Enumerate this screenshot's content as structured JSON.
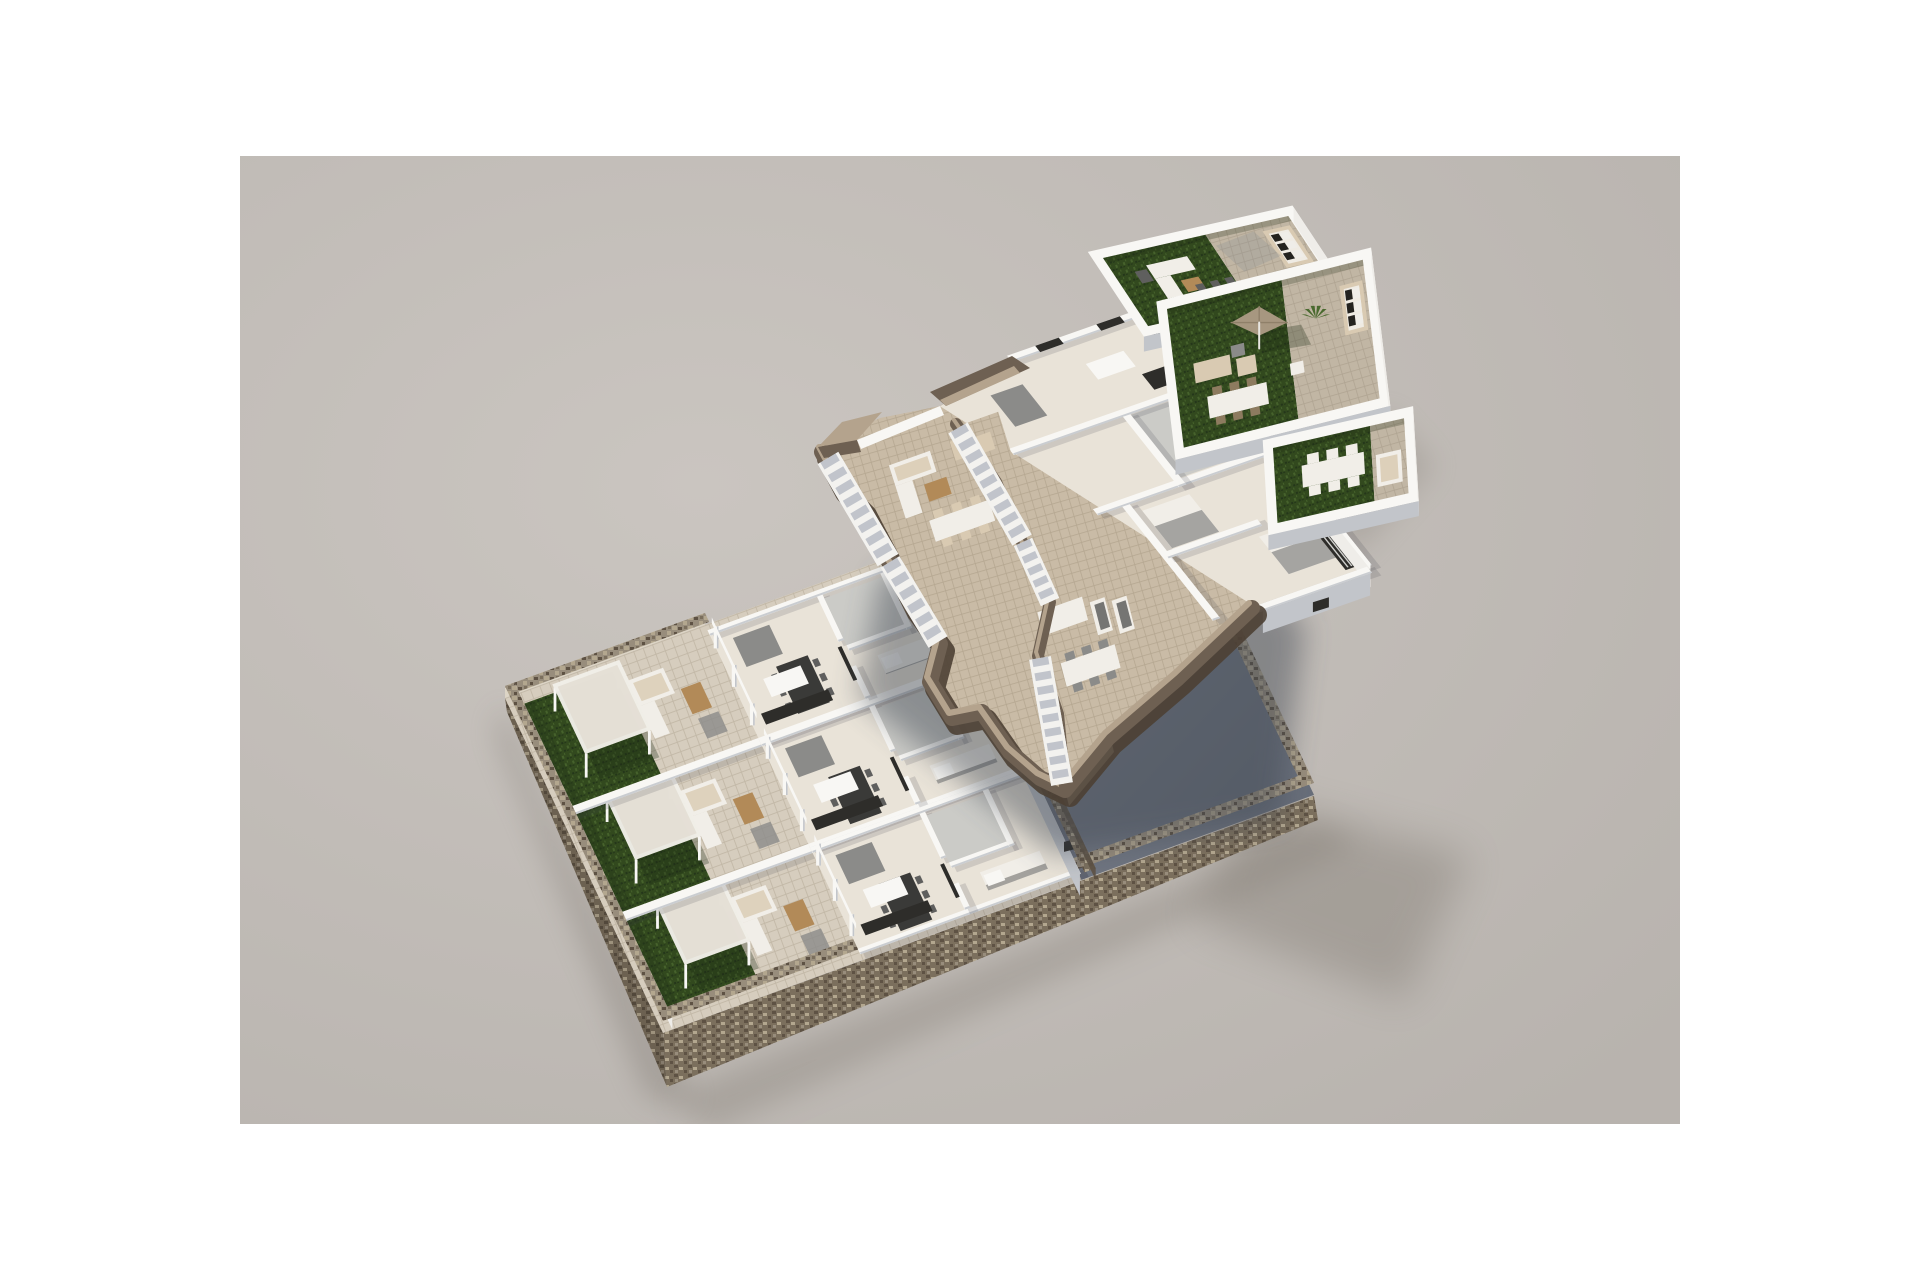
{
  "scene": {
    "type": "architectural-3d-exploded-floorplan-render",
    "render_area": {
      "x": 240,
      "y": 156,
      "width": 1440,
      "height": 968
    },
    "floors": [
      {
        "id": "ground-floor",
        "position": "bottom-left",
        "features": [
          "stone-perimeter-wall",
          "three-gardens",
          "pergolas",
          "terraces",
          "apartments",
          "sunken-patio-slab"
        ]
      },
      {
        "id": "first-floor",
        "position": "center",
        "floating": true,
        "features": [
          "rock-cut-fascia",
          "terrace-decks",
          "staircases",
          "apartments",
          "outdoor-lounge"
        ]
      },
      {
        "id": "roof-terrace",
        "position": "top-right",
        "floating": true,
        "features": [
          "three-stepped-terraces",
          "artificial-turf",
          "parasol",
          "outdoor-sofas",
          "dining-sets"
        ]
      }
    ],
    "counts": {
      "gardens": 3,
      "pergolas": 3,
      "roof_terrace_sections": 3,
      "staircases": 4
    },
    "palette": {
      "page_bg": "#ffffff",
      "canvas_center": "#cac5c0",
      "canvas_edge": "#b8b3ae",
      "stone_top": "#988d7c",
      "stone_dark": "#7b6f5d",
      "stone_speck1": "#5e5244",
      "stone_speck2": "#b3a78f",
      "stone_face_light": "#ddd5c6",
      "turf": "#32491e",
      "turf_light": "#46622c",
      "turf_dark": "#24361a",
      "slab1": "#8a8f99",
      "slab2": "#646a76",
      "tile_ground": "#d6cdbe",
      "tile_line": "#c2b8a7",
      "deck": "#c9bba6",
      "deck_line": "#b5a791",
      "wall_top": "#f8f7f4",
      "wall_lit": "#efede9",
      "wall_shade": "#c2c5ca",
      "wall_dark": "#a7abb2",
      "floor_in": "#e9e3d8",
      "floor_gray": "#cbcbc7",
      "fascia_top": "#b4a38d",
      "fascia_side": "#6e6052",
      "fascia_dark": "#4c4034",
      "step_white": "#f3f2ef",
      "step_shade": "#b7bcc4",
      "dark": "#2e2d2a",
      "gray_furn": "#8b8b89",
      "gray_dark": "#5f5f5e",
      "white_furn": "#f1eee8",
      "beige_furn": "#d9cab2",
      "wood": "#b28a58",
      "umbrella": "#a79780",
      "umbrella_seam": "#8f8069",
      "plant": "#4a6a2f",
      "shadow_warm": "#837d74",
      "shadow_cool": "#3e4450"
    }
  }
}
